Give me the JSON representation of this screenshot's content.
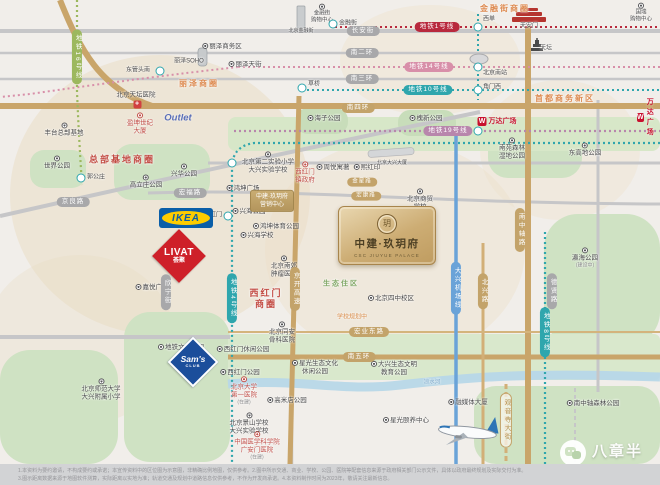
{
  "project": {
    "name": "中建·玖玥府",
    "name_en": "CSC JIUYUE PALACE",
    "emblem_char": "玥"
  },
  "watermark": {
    "brand": "八章半"
  },
  "brands": {
    "ikea": "IKEA",
    "livat": "LIVAT",
    "livat_sub": "荟聚",
    "sams": "Sam's",
    "sams_sub": "CLUB",
    "outlet": "Outlet",
    "wanda": "万达广场"
  },
  "colors": {
    "gold_road": "#c9a56a",
    "gray_road": "#c6c6c8",
    "park": "#cfe2c3",
    "water": "#b7d7e8",
    "metro_line1": "#b8293d",
    "metro_line14": "#d88fa9",
    "metro_line10": "#2fa6ad",
    "metro_line19": "#b886ac",
    "metro_line4": "#2fa6ad",
    "metro_line8": "#2fa6ad",
    "metro_line16": "#9cb85e",
    "airport_express": "#6aa3d8",
    "area_orange": "#dd8a50",
    "area_red": "#c24b43",
    "eco_green": "#7fa765",
    "card_gold": "#cdad74"
  },
  "disclaimer": {
    "line1": "1.本资料为要约邀请，不构成要约或承诺；本宣传资料中的区位图为示意图，非精确比例地图，仅供参考。2.图中所示交通、商业、学校、公园、医院等配套信息来源于政府相关部门公示文件，具体以政府最终规划及实际交付为准。",
    "line2": "3.图示距离数据来源于地图软件测算，实际距离以实地为准；轨道交通及规划中道路信息仅供参考，不作为开发商承诺。4.本资料制作时间为2023年，敬请关注最新信息。"
  },
  "map_items": [
    {
      "n": "area-jinrongjie",
      "t": "area",
      "x": 505,
      "y": 9,
      "l": "金融街商圈",
      "c": "#dd8a50",
      "fs": 8
    },
    {
      "n": "area-lize",
      "t": "area",
      "x": 199,
      "y": 84,
      "l": "丽泽商圈",
      "c": "#dd8a50",
      "fs": 8
    },
    {
      "n": "area-zongbujidi",
      "t": "area",
      "x": 122,
      "y": 160,
      "l": "总部基地商圈",
      "c": "#c24b43",
      "fs": 9
    },
    {
      "n": "area-shoudushangwu",
      "t": "area",
      "x": 565,
      "y": 99,
      "l": "首都商务新区",
      "c": "#dd8a50",
      "fs": 8
    },
    {
      "n": "area-xihongmen",
      "t": "area",
      "x": 266,
      "y": 299,
      "l": [
        "西红门",
        "商圈"
      ],
      "c": "#c24b43",
      "fs": 9
    },
    {
      "n": "area-shengtai",
      "t": "area",
      "x": 341,
      "y": 285,
      "l": "生态住区",
      "c": "#7fa765",
      "fs": 7
    },
    {
      "n": "label-school-planning",
      "t": "label",
      "x": 352,
      "y": 318,
      "l": "学校规划中",
      "c": "#d98c4a",
      "fs": 6
    },
    {
      "n": "pill-changanjie",
      "t": "pill",
      "s": "gray",
      "x": 363,
      "y": 31,
      "l": "长安街"
    },
    {
      "n": "pill-nanerhuan",
      "t": "pill",
      "s": "gray",
      "x": 362,
      "y": 53,
      "l": "南二环"
    },
    {
      "n": "pill-nansanhuan",
      "t": "pill",
      "s": "gray",
      "x": 362,
      "y": 79,
      "l": "南三环"
    },
    {
      "n": "pill-nansihuan",
      "t": "pill",
      "s": "gold",
      "x": 358,
      "y": 108,
      "l": "南四环"
    },
    {
      "n": "pill-nanwuhuan",
      "t": "pill",
      "s": "gold",
      "x": 359,
      "y": 357,
      "l": "南五环"
    },
    {
      "n": "pill-jinglianglu",
      "t": "pill",
      "s": "gray",
      "x": 73,
      "y": 202,
      "l": "京良路"
    },
    {
      "n": "pill-hongfulu",
      "t": "pill",
      "s": "gray",
      "x": 190,
      "y": 193,
      "l": "宏福路"
    },
    {
      "n": "pill-xinningjie",
      "t": "pill",
      "s": "gray",
      "v": 1,
      "x": 166,
      "y": 292,
      "l": "欣宁街"
    },
    {
      "n": "pill-jingkai-expwy",
      "t": "pill",
      "s": "gold",
      "v": 1,
      "x": 295,
      "y": 289,
      "l": "京开高速"
    },
    {
      "n": "pill-nanzhongzhoulu",
      "t": "pill",
      "s": "gold",
      "v": 1,
      "x": 520,
      "y": 230,
      "l": "南中轴路"
    },
    {
      "n": "pill-beixinglu",
      "t": "pill",
      "s": "gold",
      "v": 1,
      "x": 483,
      "y": 291,
      "l": "北兴路"
    },
    {
      "n": "pill-dexianlu",
      "t": "pill",
      "s": "gray",
      "v": 1,
      "x": 552,
      "y": 291,
      "l": "德贤路"
    },
    {
      "n": "pill-guanyinsi-dajie",
      "t": "pill",
      "s": "goldline",
      "v": 1,
      "x": 506,
      "y": 420,
      "l": "观音寺大街"
    },
    {
      "n": "pill-hongye-donglu",
      "t": "pill",
      "s": "gold",
      "x": 369,
      "y": 332,
      "l": "宏业东路"
    },
    {
      "n": "pill-jinxinglu",
      "t": "pill",
      "s": "gold",
      "x": 362,
      "y": 182,
      "l": "金星路",
      "fs": 5.5
    },
    {
      "n": "pill-hongkanglu",
      "t": "pill",
      "s": "gold",
      "x": 366,
      "y": 196,
      "l": "宏康路",
      "fs": 5.5
    },
    {
      "n": "pill-metro-line1",
      "t": "pill",
      "s": "red",
      "x": 437,
      "y": 27,
      "l": "地铁1号线"
    },
    {
      "n": "pill-metro-line14",
      "t": "pill",
      "s": "pink",
      "x": 429,
      "y": 67,
      "l": "地铁14号线"
    },
    {
      "n": "pill-metro-line10",
      "t": "pill",
      "s": "teal",
      "x": 428,
      "y": 90,
      "l": "地铁10号线"
    },
    {
      "n": "pill-metro-line19",
      "t": "pill",
      "s": "purple",
      "x": 448,
      "y": 131,
      "l": "地铁19号线"
    },
    {
      "n": "pill-metro-line4",
      "t": "pill",
      "s": "teal",
      "v": 1,
      "x": 232,
      "y": 298,
      "l": "地铁4号线"
    },
    {
      "n": "pill-metro-line8",
      "t": "pill",
      "s": "teal",
      "v": 1,
      "x": 545,
      "y": 332,
      "l": "地铁8号线"
    },
    {
      "n": "pill-airport-express",
      "t": "pill",
      "s": "blue",
      "v": 1,
      "x": 456,
      "y": 288,
      "l": "大兴机场线"
    },
    {
      "n": "pill-metro-line16",
      "t": "pill",
      "s": "green",
      "v": 1,
      "x": 77,
      "y": 57,
      "l": "地铁16号线"
    },
    {
      "n": "station-xidan",
      "t": "station",
      "x": 478,
      "y": 27
    },
    {
      "n": "station-beijingnanzhan",
      "t": "station",
      "x": 478,
      "y": 67
    },
    {
      "n": "station-jiaomenxi",
      "t": "station",
      "x": 478,
      "y": 90
    },
    {
      "n": "station-caoqiao",
      "t": "station",
      "x": 302,
      "y": 88
    },
    {
      "n": "station-dongguantounan",
      "t": "station",
      "x": 160,
      "y": 71
    },
    {
      "n": "station-line4-cross",
      "t": "station",
      "x": 232,
      "y": 163
    },
    {
      "n": "station-xihongmen",
      "t": "station",
      "x": 228,
      "y": 216
    },
    {
      "n": "station-guogongzhuang",
      "t": "station",
      "x": 81,
      "y": 178
    },
    {
      "n": "station-jinrongjie",
      "t": "station",
      "x": 333,
      "y": 24
    },
    {
      "n": "station-line19",
      "t": "station",
      "x": 478,
      "y": 131
    },
    {
      "n": "label-xidan",
      "t": "label",
      "x": 489,
      "y": 20,
      "l": "西单",
      "fs": 6
    },
    {
      "n": "label-beijingnanzhan",
      "t": "label",
      "x": 495,
      "y": 74,
      "l": "北京南站",
      "fs": 6
    },
    {
      "n": "label-jiaomenxi",
      "t": "label",
      "x": 492,
      "y": 88,
      "l": "角门西",
      "fs": 6
    },
    {
      "n": "label-caoqiao",
      "t": "label",
      "x": 314,
      "y": 85,
      "l": "草桥",
      "fs": 6
    },
    {
      "n": "label-dongguantounan",
      "t": "label",
      "x": 138,
      "y": 71,
      "l": "东管头南",
      "fs": 6
    },
    {
      "n": "label-xihongmen-station",
      "t": "label",
      "x": 213,
      "y": 216,
      "l": "西红门",
      "fs": 6
    },
    {
      "n": "label-guogongzhuang",
      "t": "label",
      "x": 96,
      "y": 178,
      "l": "郭公庄",
      "fs": 6
    },
    {
      "n": "label-jinrongjie-station",
      "t": "label",
      "x": 348,
      "y": 24,
      "l": "金融街",
      "fs": 6
    },
    {
      "n": "label-tiananmen",
      "t": "label",
      "x": 529,
      "y": 27,
      "l": "天安门",
      "fs": 6
    },
    {
      "n": "label-tiantan",
      "t": "label",
      "x": 546,
      "y": 49,
      "l": "天坛",
      "fs": 6
    },
    {
      "n": "label-lizesoho",
      "t": "label",
      "x": 189,
      "y": 62,
      "l": "丽泽SOHO",
      "fs": 6
    },
    {
      "n": "label-bjjinrongjie-tower",
      "t": "label",
      "x": 301,
      "y": 31,
      "l": "北京金融街",
      "fs": 5
    },
    {
      "n": "label-daxing-building",
      "t": "label",
      "x": 392,
      "y": 163,
      "l": "北京大兴大厦",
      "fs": 5
    },
    {
      "n": "label-liangshuihe",
      "t": "label",
      "x": 432,
      "y": 383,
      "l": "凉水河",
      "c": "#7ba7c9",
      "fs": 5.5
    },
    {
      "n": "poi-lize-cbd",
      "t": "poi",
      "dp": "left",
      "x": 222,
      "y": 47,
      "l": "丽泽商务区"
    },
    {
      "n": "poi-lize-tianjie",
      "t": "poi",
      "dp": "left",
      "x": 245,
      "y": 65,
      "l": "丽泽天街"
    },
    {
      "n": "poi-jinrongjie-mall",
      "t": "poi",
      "dp": "top",
      "x": 322,
      "y": 14,
      "l": [
        "金融街",
        "购物中心"
      ],
      "fs": 5.5
    },
    {
      "n": "poi-guorui-mall",
      "t": "poi",
      "dp": "top",
      "x": 641,
      "y": 13,
      "l": [
        "国瑞",
        "购物中心"
      ],
      "fs": 5.5
    },
    {
      "n": "poi-tiantan-hospital",
      "t": "poi",
      "ic": "cross",
      "x": 136,
      "y": 100,
      "l": "北京天坛医院"
    },
    {
      "n": "poi-yingkun-tower",
      "t": "poi",
      "red": 1,
      "dp": "top",
      "x": 140,
      "y": 124,
      "l": [
        "盈坤世纪",
        "大厦"
      ]
    },
    {
      "n": "poi-fengtai-hq",
      "t": "poi",
      "dp": "top",
      "x": 64,
      "y": 130,
      "l": "丰台总部基地"
    },
    {
      "n": "poi-world-park",
      "t": "poi",
      "dp": "top",
      "x": 57,
      "y": 163,
      "l": "世界公园"
    },
    {
      "n": "poi-gaolizhuang-park",
      "t": "poi",
      "dp": "top",
      "x": 146,
      "y": 182,
      "l": "高立庄公园"
    },
    {
      "n": "poi-xinghua-park",
      "t": "poi",
      "dp": "top",
      "x": 184,
      "y": 171,
      "l": "兴华公园"
    },
    {
      "n": "poi-jiayue-plaza",
      "t": "poi",
      "dp": "left",
      "x": 152,
      "y": 288,
      "l": "嘉悦广场"
    },
    {
      "n": "poi-hongkun-plaza",
      "t": "poi",
      "dp": "left",
      "x": 243,
      "y": 189,
      "l": "鸿坤广场"
    },
    {
      "n": "poi-xinghai-park",
      "t": "poi",
      "dp": "left",
      "x": 249,
      "y": 212,
      "l": "兴海公园"
    },
    {
      "n": "poi-hongkun-sports-park",
      "t": "poi",
      "dp": "left",
      "x": 276,
      "y": 227,
      "l": "鸿坤体育公园"
    },
    {
      "n": "poi-xinghai-school",
      "t": "poi",
      "dp": "left",
      "x": 257,
      "y": 236,
      "l": "兴海学校"
    },
    {
      "n": "poi-nanjiao-tumor-hospital",
      "t": "poi",
      "dp": "top",
      "x": 284,
      "y": 267,
      "l": [
        "北京南郊",
        "肿瘤医院"
      ]
    },
    {
      "n": "poi-tongan-hospital",
      "t": "poi",
      "dp": "top",
      "x": 282,
      "y": 333,
      "l": [
        "北京同安",
        "骨科医院"
      ]
    },
    {
      "n": "poi-no2-experimental-school",
      "t": "poi",
      "dp": "top",
      "x": 268,
      "y": 163,
      "l": [
        "北京第二实验小学",
        "大兴实验学校"
      ]
    },
    {
      "n": "poi-xihongmen-gov",
      "t": "poi",
      "red": 1,
      "dp": "top",
      "x": 305,
      "y": 173,
      "l": [
        "西红门",
        "镇政府"
      ]
    },
    {
      "n": "poi-zhouyue-yuzhu",
      "t": "poi",
      "dp": "left",
      "x": 333,
      "y": 168,
      "l": "周悦寓著"
    },
    {
      "n": "poi-xihongyin",
      "t": "poi",
      "dp": "left",
      "x": 367,
      "y": 168,
      "l": "熙红印"
    },
    {
      "n": "poi-shangmao-school",
      "t": "poi",
      "dp": "top",
      "x": 420,
      "y": 200,
      "l": [
        "北京商贸",
        "学校"
      ]
    },
    {
      "n": "poi-runze-school",
      "t": "poi",
      "red": 1,
      "x": 420,
      "y": 229,
      "l": [
        "北京金融街",
        "润泽学校"
      ]
    },
    {
      "n": "poi-sizhong-campus",
      "t": "poi",
      "dp": "left",
      "x": 391,
      "y": 299,
      "l": "北京四中校区"
    },
    {
      "n": "poi-haizi-park",
      "t": "poi",
      "dp": "left",
      "x": 324,
      "y": 119,
      "l": "海子公园"
    },
    {
      "n": "poi-huaixin-park",
      "t": "poi",
      "dp": "left",
      "x": 426,
      "y": 119,
      "l": "槐新公园"
    },
    {
      "n": "poi-nanyuan-wetland-park",
      "t": "poi",
      "dp": "top",
      "x": 512,
      "y": 149,
      "l": [
        "南苑森林",
        "湿地公园"
      ]
    },
    {
      "n": "poi-donggaodi-park",
      "t": "poi",
      "dp": "top",
      "x": 585,
      "y": 150,
      "l": "东高地公园"
    },
    {
      "n": "poi-yinghai-park",
      "t": "poi",
      "dp": "top",
      "x": 585,
      "y": 258,
      "l": "瀛海公园",
      "sub": "(建设中)"
    },
    {
      "n": "poi-ditie-culture-park",
      "t": "poi",
      "dp": "left",
      "x": 181,
      "y": 348,
      "l": "地铁文化公园"
    },
    {
      "n": "poi-xihongmen-leisure-park",
      "t": "poi",
      "dp": "left",
      "x": 243,
      "y": 350,
      "l": "西红门休闲公园"
    },
    {
      "n": "poi-xihongmen-park",
      "t": "poi",
      "dp": "left",
      "x": 240,
      "y": 373,
      "l": "西红门公园"
    },
    {
      "n": "poi-bnu-primary",
      "t": "poi",
      "dp": "top",
      "x": 101,
      "y": 390,
      "l": [
        "北京师范大学",
        "大兴附属小学"
      ]
    },
    {
      "n": "poi-pku-first-hospital",
      "t": "poi",
      "red": 1,
      "dp": "top",
      "x": 244,
      "y": 391,
      "l": [
        "北京大学",
        "第一医院"
      ],
      "sub": "(在建)"
    },
    {
      "n": "poi-gaomidian-park",
      "t": "poi",
      "dp": "left",
      "x": 287,
      "y": 401,
      "l": "高米店公园"
    },
    {
      "n": "poi-jingshan-school",
      "t": "poi",
      "dp": "top",
      "x": 249,
      "y": 424,
      "l": [
        "北京景山学校",
        "大兴实验学校"
      ]
    },
    {
      "n": "poi-guanganmen-hospital",
      "t": "poi",
      "red": 1,
      "dp": "top",
      "x": 257,
      "y": 446,
      "l": [
        "中国医学科学院",
        "广安门医院"
      ],
      "sub": "(在建)"
    },
    {
      "n": "poi-xingguang-eco-park",
      "t": "poi",
      "dp": "left",
      "x": 315,
      "y": 368,
      "l": [
        "星光生态文化",
        "休闲公园"
      ]
    },
    {
      "n": "poi-daxing-eco-edu-park",
      "t": "poi",
      "dp": "left",
      "x": 394,
      "y": 369,
      "l": [
        "大兴生态文明",
        "教育公园"
      ]
    },
    {
      "n": "poi-xingguang-center",
      "t": "poi",
      "dp": "left",
      "x": 406,
      "y": 421,
      "l": "星光颐养中心"
    },
    {
      "n": "poi-rongmeiti-tower",
      "t": "poi",
      "dp": "left",
      "x": 468,
      "y": 403,
      "l": "融媒体大厦"
    },
    {
      "n": "poi-nanzhongzhou-forest-park",
      "t": "poi",
      "dp": "left",
      "x": 593,
      "y": 404,
      "l": "南中轴森林公园"
    },
    {
      "n": "tag-sales-center",
      "t": "tag",
      "x": 272,
      "y": 201,
      "l": [
        "中建·玖玥府",
        "营销中心"
      ]
    }
  ]
}
